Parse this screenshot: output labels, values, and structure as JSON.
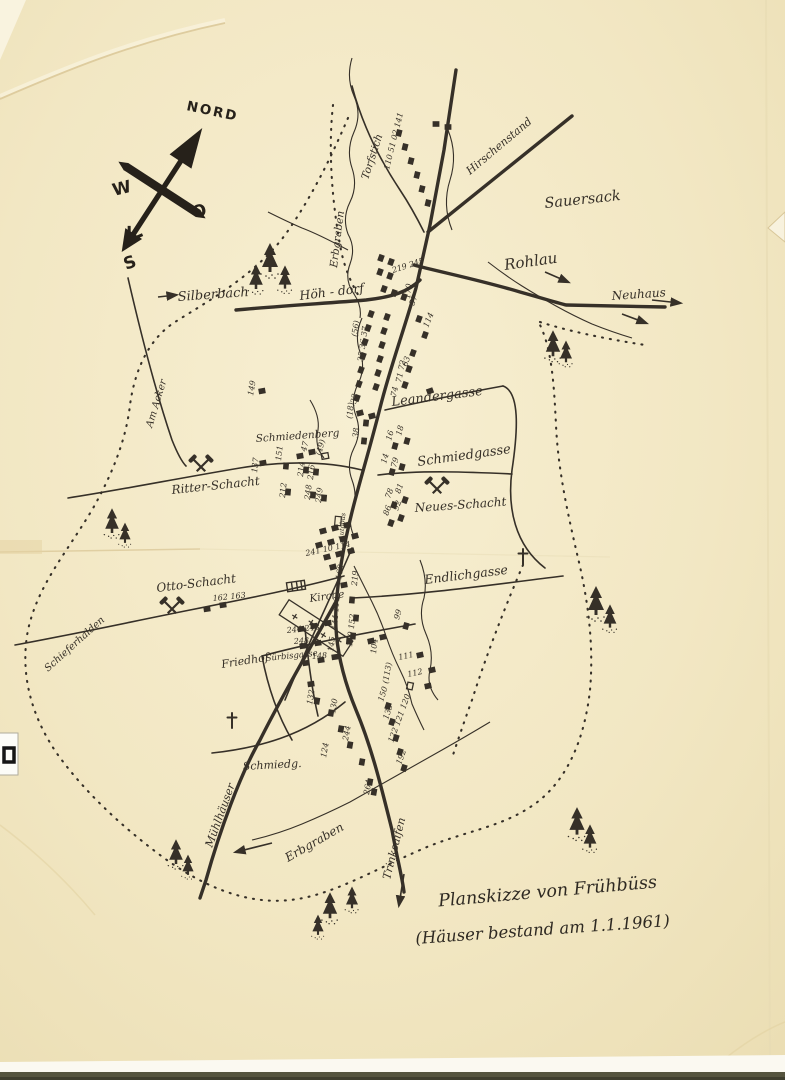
{
  "title": {
    "line1": "Planskizze von Frühbüss",
    "line2": "(Häuser bestand am 1.1.1961)"
  },
  "compass": {
    "north": "NORD",
    "west": "W",
    "east": "O",
    "south": "S"
  },
  "colors": {
    "paper": "#f2e7c3",
    "ink": "#363028",
    "crease": "#dcc99a",
    "scan_edge": "#55543e"
  },
  "labels": [
    {
      "n": "silberbach",
      "t": "Silberbach",
      "x": 178,
      "y": 301,
      "r": -4,
      "s": 13
    },
    {
      "n": "hoeh-dorf",
      "t": "Höh - dorf",
      "x": 300,
      "y": 300,
      "r": -7,
      "s": 12.5
    },
    {
      "n": "erbgraben-nord",
      "t": "Erbgraben",
      "x": 337,
      "y": 268,
      "r": -83,
      "s": 10.5
    },
    {
      "n": "torfstich",
      "t": "Torfstich",
      "x": 368,
      "y": 180,
      "r": -72,
      "s": 10.5
    },
    {
      "n": "hirschenstand",
      "t": "Hirschenstand",
      "x": 470,
      "y": 175,
      "r": -40,
      "s": 11
    },
    {
      "n": "sauersack",
      "t": "Sauersack",
      "x": 545,
      "y": 208,
      "r": -6,
      "s": 14.5
    },
    {
      "n": "rohlau",
      "t": "Rohlau",
      "x": 505,
      "y": 270,
      "r": -8,
      "s": 15
    },
    {
      "n": "neuhaus",
      "t": "Neuhaus",
      "x": 612,
      "y": 300,
      "r": -4,
      "s": 12
    },
    {
      "n": "leandergasse",
      "t": "Leandergasse",
      "x": 392,
      "y": 406,
      "r": -7,
      "s": 13
    },
    {
      "n": "schmiedgasse",
      "t": "Schmiedgasse",
      "x": 418,
      "y": 466,
      "r": -8,
      "s": 13
    },
    {
      "n": "neues-schacht",
      "t": "Neues-Schacht",
      "x": 415,
      "y": 512,
      "r": -4,
      "s": 12
    },
    {
      "n": "schmiedenberg",
      "t": "Schmiedenberg",
      "x": 256,
      "y": 442,
      "r": -4,
      "s": 10.5
    },
    {
      "n": "ritter-schacht",
      "t": "Ritter-Schacht",
      "x": 172,
      "y": 494,
      "r": -6,
      "s": 12
    },
    {
      "n": "am-acker",
      "t": "Am Acker",
      "x": 152,
      "y": 428,
      "r": -73,
      "s": 10
    },
    {
      "n": "otto-schacht",
      "t": "Otto-Schacht",
      "x": 157,
      "y": 592,
      "r": -7,
      "s": 12
    },
    {
      "n": "schieferhalden",
      "t": "Schieferhalden",
      "x": 48,
      "y": 672,
      "r": -42,
      "s": 10
    },
    {
      "n": "kirche",
      "t": "Kirche",
      "x": 310,
      "y": 602,
      "r": -8,
      "s": 10.5
    },
    {
      "n": "friedhof",
      "t": "Friedhof",
      "x": 222,
      "y": 668,
      "r": -9,
      "s": 11
    },
    {
      "n": "endlichgasse",
      "t": "Endlichgasse",
      "x": 425,
      "y": 584,
      "r": -7,
      "s": 12.5
    },
    {
      "n": "suerbisgasse",
      "t": "Sürbisgasse",
      "x": 266,
      "y": 661,
      "r": -6,
      "s": 8.5
    },
    {
      "n": "schmiedg",
      "t": "Schmiedg.",
      "x": 243,
      "y": 770,
      "r": -3,
      "s": 11
    },
    {
      "n": "muehlhaeuser",
      "t": "Mühlhäuser",
      "x": 212,
      "y": 848,
      "r": -70,
      "s": 11
    },
    {
      "n": "erbgraben-sued",
      "t": "Erbgraben",
      "x": 288,
      "y": 862,
      "r": -30,
      "s": 12
    },
    {
      "n": "trinksaifen",
      "t": "Trinksaifen",
      "x": 390,
      "y": 880,
      "r": -76,
      "s": 11
    },
    {
      "n": "autobus",
      "t": "Autobus",
      "x": 343,
      "y": 540,
      "r": -85,
      "s": 6.5
    }
  ],
  "house_numbers": [
    [
      "110 51 02 141",
      389,
      170,
      -76
    ],
    [
      "219 245",
      393,
      273,
      -18
    ],
    [
      "170",
      410,
      299,
      -84
    ],
    [
      "149",
      253,
      396,
      -80
    ],
    [
      "57",
      414,
      306,
      -68
    ],
    [
      "114",
      428,
      328,
      -68
    ],
    [
      "(56)",
      357,
      337,
      -82
    ],
    [
      "35 36 37",
      363,
      362,
      -82
    ],
    [
      "63",
      407,
      367,
      -72
    ],
    [
      "71 72",
      401,
      383,
      -78
    ],
    [
      "74",
      396,
      397,
      -78
    ],
    [
      "32",
      356,
      404,
      -80
    ],
    [
      "(18)",
      352,
      419,
      -84
    ],
    [
      "38",
      358,
      438,
      -84
    ],
    [
      "16",
      391,
      441,
      -74
    ],
    [
      "18",
      401,
      436,
      -74
    ],
    [
      "14",
      386,
      464,
      -74
    ],
    [
      "79",
      396,
      468,
      -74
    ],
    [
      "78",
      390,
      499,
      -70
    ],
    [
      "81",
      400,
      494,
      -70
    ],
    [
      "86",
      388,
      516,
      -70
    ],
    [
      "92",
      398,
      511,
      -70
    ],
    [
      "47",
      306,
      452,
      -76
    ],
    [
      "(49)",
      321,
      456,
      -76
    ],
    [
      "137",
      257,
      473,
      -84
    ],
    [
      "151",
      281,
      461,
      -84
    ],
    [
      "214",
      303,
      477,
      -84
    ],
    [
      "216",
      313,
      480,
      -84
    ],
    [
      "212",
      285,
      498,
      -84
    ],
    [
      "248",
      310,
      500,
      -84
    ],
    [
      "249",
      321,
      503,
      -84
    ],
    [
      "241 10 114",
      306,
      556,
      -12
    ],
    [
      "168",
      341,
      580,
      -80
    ],
    [
      "144 110",
      337,
      630,
      -86
    ],
    [
      "219",
      357,
      586,
      -86
    ],
    [
      "162 163",
      213,
      601,
      -6
    ],
    [
      "99",
      399,
      620,
      -74
    ],
    [
      "244 243",
      287,
      633,
      -6
    ],
    [
      "248",
      294,
      644,
      -4
    ],
    [
      "148",
      312,
      659,
      -4
    ],
    [
      "145",
      333,
      652,
      -82
    ],
    [
      "150 152",
      352,
      647,
      -84
    ],
    [
      "104",
      376,
      654,
      -84
    ],
    [
      "111",
      399,
      660,
      -12
    ],
    [
      "112",
      408,
      677,
      -12
    ],
    [
      "(113)",
      388,
      684,
      -80
    ],
    [
      "150",
      383,
      702,
      -72
    ],
    [
      "133",
      388,
      720,
      -72
    ],
    [
      "122 121 120",
      393,
      743,
      -70
    ],
    [
      "192",
      401,
      765,
      -70
    ],
    [
      "132",
      312,
      705,
      -80
    ],
    [
      "130",
      335,
      714,
      -80
    ],
    [
      "244",
      348,
      741,
      -80
    ],
    [
      "124",
      326,
      758,
      -80
    ],
    [
      "264",
      369,
      795,
      -80
    ]
  ],
  "houses": {
    "filled": [
      [
        399,
        133,
        -76
      ],
      [
        405,
        147,
        -76
      ],
      [
        411,
        161,
        -76
      ],
      [
        417,
        175,
        -76
      ],
      [
        422,
        189,
        -76
      ],
      [
        428,
        203,
        -76
      ],
      [
        436,
        124,
        0
      ],
      [
        448,
        127,
        0
      ],
      [
        381,
        258,
        -70
      ],
      [
        391,
        262,
        -70
      ],
      [
        380,
        272,
        -70
      ],
      [
        390,
        276,
        -70
      ],
      [
        384,
        289,
        -70
      ],
      [
        394,
        293,
        -70
      ],
      [
        404,
        297,
        -70
      ],
      [
        371,
        314,
        -70
      ],
      [
        368,
        328,
        -70
      ],
      [
        365,
        342,
        -70
      ],
      [
        363,
        356,
        -70
      ],
      [
        361,
        370,
        -70
      ],
      [
        359,
        384,
        -70
      ],
      [
        357,
        398,
        -70
      ],
      [
        387,
        317,
        -70
      ],
      [
        384,
        331,
        -70
      ],
      [
        382,
        345,
        -70
      ],
      [
        380,
        359,
        -70
      ],
      [
        378,
        373,
        -70
      ],
      [
        376,
        387,
        -70
      ],
      [
        419,
        319,
        -70
      ],
      [
        425,
        335,
        -70
      ],
      [
        413,
        353,
        -70
      ],
      [
        409,
        369,
        -70
      ],
      [
        405,
        385,
        -70
      ],
      [
        430,
        391,
        -20
      ],
      [
        262,
        391,
        -10
      ],
      [
        360,
        413,
        -15
      ],
      [
        372,
        416,
        -15
      ],
      [
        366,
        423,
        -84
      ],
      [
        364,
        441,
        -84
      ],
      [
        395,
        446,
        -74
      ],
      [
        407,
        441,
        -74
      ],
      [
        392,
        472,
        -74
      ],
      [
        402,
        467,
        -74
      ],
      [
        394,
        505,
        -70
      ],
      [
        405,
        500,
        -70
      ],
      [
        391,
        523,
        -70
      ],
      [
        401,
        518,
        -70
      ],
      [
        300,
        456,
        -10
      ],
      [
        312,
        452,
        -10
      ],
      [
        263,
        463,
        -10
      ],
      [
        286,
        466,
        -85
      ],
      [
        306,
        470,
        -85
      ],
      [
        316,
        472,
        -85
      ],
      [
        288,
        492,
        -85
      ],
      [
        313,
        495,
        -85
      ],
      [
        324,
        498,
        -85
      ],
      [
        323,
        531,
        -15
      ],
      [
        335,
        528,
        -15
      ],
      [
        347,
        525,
        -15
      ],
      [
        319,
        545,
        -15
      ],
      [
        331,
        542,
        -15
      ],
      [
        343,
        539,
        -15
      ],
      [
        355,
        536,
        -15
      ],
      [
        327,
        557,
        -15
      ],
      [
        339,
        554,
        -15
      ],
      [
        351,
        551,
        -15
      ],
      [
        333,
        567,
        -15
      ],
      [
        344,
        585,
        -10
      ],
      [
        352,
        600,
        -85
      ],
      [
        356,
        618,
        -85
      ],
      [
        353,
        636,
        -85
      ],
      [
        207,
        609,
        -8
      ],
      [
        223,
        605,
        -8
      ],
      [
        406,
        626,
        -74
      ],
      [
        301,
        629,
        -8
      ],
      [
        314,
        626,
        -8
      ],
      [
        328,
        623,
        -8
      ],
      [
        303,
        646,
        -8
      ],
      [
        318,
        643,
        -8
      ],
      [
        306,
        663,
        -8
      ],
      [
        321,
        660,
        -8
      ],
      [
        335,
        657,
        -8
      ],
      [
        349,
        641,
        -85
      ],
      [
        371,
        641,
        -12
      ],
      [
        383,
        637,
        -12
      ],
      [
        311,
        684,
        -8
      ],
      [
        317,
        701,
        -80
      ],
      [
        331,
        713,
        -80
      ],
      [
        341,
        729,
        -80
      ],
      [
        350,
        745,
        -80
      ],
      [
        362,
        762,
        -80
      ],
      [
        370,
        782,
        -80
      ],
      [
        388,
        706,
        -72
      ],
      [
        392,
        722,
        -72
      ],
      [
        396,
        738,
        -72
      ],
      [
        400,
        752,
        -72
      ],
      [
        404,
        768,
        -72
      ],
      [
        420,
        655,
        -12
      ],
      [
        432,
        670,
        -12
      ],
      [
        428,
        686,
        -12
      ],
      [
        374,
        792,
        -80
      ]
    ],
    "hollow": [
      [
        325,
        456,
        -10
      ],
      [
        410,
        686,
        -78
      ]
    ]
  },
  "trees": [
    [
      270,
      265,
      1
    ],
    [
      256,
      283,
      0.85
    ],
    [
      285,
      283,
      0.8
    ],
    [
      553,
      350,
      0.9
    ],
    [
      566,
      357,
      0.75
    ],
    [
      112,
      527,
      0.85
    ],
    [
      125,
      538,
      0.7
    ],
    [
      596,
      608,
      1
    ],
    [
      610,
      622,
      0.8
    ],
    [
      577,
      828,
      0.95
    ],
    [
      590,
      842,
      0.8
    ],
    [
      176,
      858,
      0.85
    ],
    [
      188,
      870,
      0.7
    ],
    [
      330,
      912,
      0.9
    ],
    [
      352,
      903,
      0.75
    ],
    [
      318,
      930,
      0.7
    ]
  ],
  "mines": [
    [
      201,
      467,
      "ritter-schacht"
    ],
    [
      172,
      609,
      "otto-schacht"
    ],
    [
      437,
      489,
      "neues-schacht"
    ]
  ],
  "crosses": [
    [
      523,
      556
    ],
    [
      232,
      720
    ]
  ],
  "arrows": [
    [
      158,
      297,
      176,
      295
    ],
    [
      652,
      300,
      680,
      303
    ],
    [
      545,
      272,
      568,
      282
    ],
    [
      622,
      314,
      646,
      323
    ],
    [
      272,
      843,
      236,
      852
    ],
    [
      404,
      874,
      399,
      905
    ]
  ]
}
